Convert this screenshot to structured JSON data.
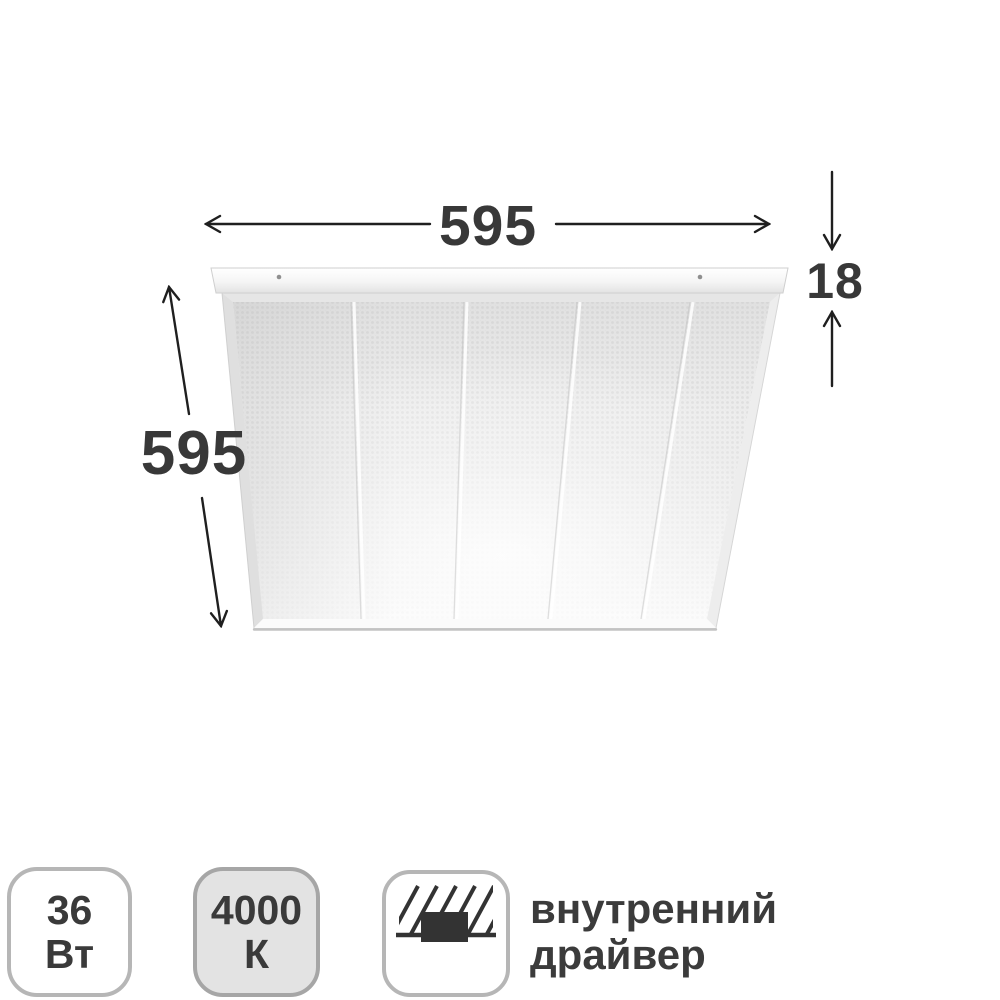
{
  "diagram": {
    "width_label": "595",
    "depth_label": "595",
    "thickness_label": "18"
  },
  "badges": {
    "power": {
      "line1": "36",
      "line2": "Вт"
    },
    "color_temperature": {
      "line1": "4000",
      "line2": "К"
    },
    "driver": {
      "icon": "recessed-driver-icon",
      "line1": "внутренний",
      "line2": "драйвер"
    }
  },
  "colors": {
    "dimension_text": "#383838",
    "arrow": "#1f1f1f",
    "badge_text": "#3a3a3a",
    "badge_gray_background": "#e3e3e3",
    "badge_border": "#b6b6b6",
    "panel_face": "#ededed"
  }
}
